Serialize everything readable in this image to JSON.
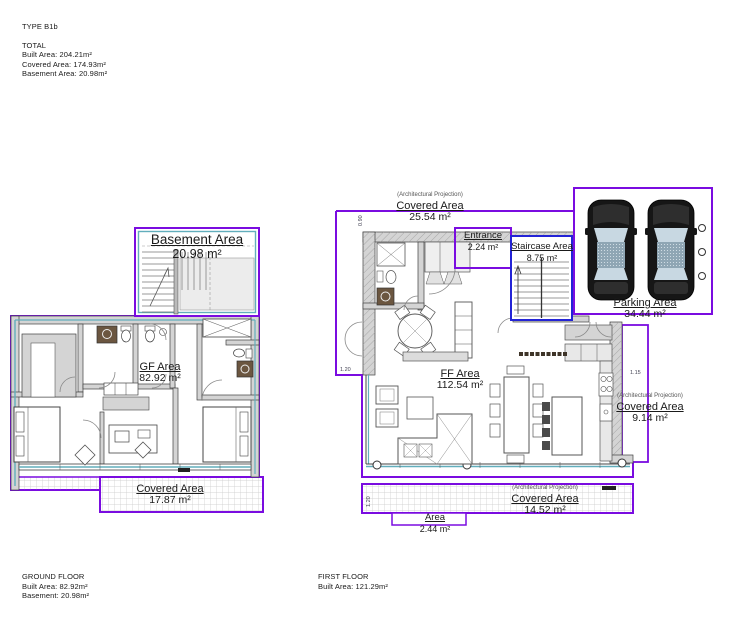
{
  "sheet": {
    "title": "TYPE B1b",
    "total": {
      "heading": "TOTAL",
      "built": "Built Area: 204.21m²",
      "covered": "Covered Area: 174.93m²",
      "basement": "Basement Area: 20.98m²"
    }
  },
  "ground_floor": {
    "basement_label": {
      "name": "Basement Area",
      "value": "20.98 m²"
    },
    "gf_label": {
      "name": "GF Area",
      "value": "82.92 m²"
    },
    "covered_label": {
      "name": "Covered Area",
      "value": "17.87 m²"
    },
    "footer": {
      "heading": "GROUND FLOOR",
      "built": "Built Area: 82.92m²",
      "basement": "Basement: 20.98m²"
    }
  },
  "first_floor": {
    "covered_top": {
      "note": "(Architectural Projection)",
      "name": "Covered Area",
      "value": "25.54 m²"
    },
    "entrance": {
      "name": "Entrance",
      "value": "2.24 m²"
    },
    "staircase": {
      "name": "Staircase Area",
      "value": "8.75 m²"
    },
    "ff_label": {
      "name": "FF Area",
      "value": "112.54 m²"
    },
    "covered_right": {
      "note": "(Architectural Projection)",
      "name": "Covered Area",
      "value": "9.14 m²"
    },
    "covered_bottom": {
      "note": "(Architectural Projection)",
      "name": "Covered Area",
      "value": "14.52 m²"
    },
    "area_small": {
      "name": "Area",
      "value": "2.44 m²"
    },
    "dims": {
      "top": "0.90",
      "left": "1.20",
      "right": "1.15",
      "bottom": "1.20"
    },
    "footer": {
      "heading": "FIRST FLOOR",
      "built": "Built Area: 121.29m²"
    }
  },
  "parking": {
    "label": {
      "name": "Parking Area",
      "value": "34.44 m²"
    }
  },
  "colors": {
    "boundary": "#7a0ce0",
    "staircase_boundary": "#2323d6",
    "glazing": "#62aebc",
    "wall_fill": "#d4d4d4"
  }
}
